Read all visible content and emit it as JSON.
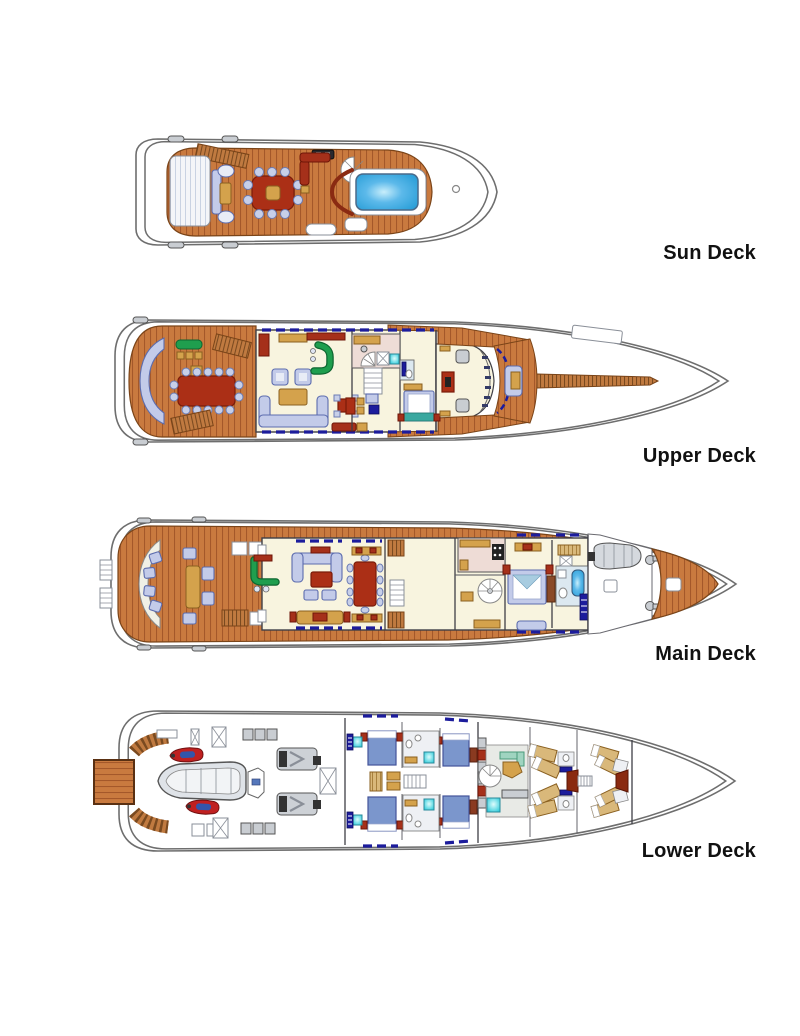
{
  "page": {
    "background": "#ffffff"
  },
  "decks": [
    {
      "id": "sun-deck",
      "label": "Sun Deck"
    },
    {
      "id": "upper-deck",
      "label": "Upper Deck"
    },
    {
      "id": "main-deck",
      "label": "Main Deck"
    },
    {
      "id": "lower-deck",
      "label": "Lower Deck"
    }
  ],
  "colors": {
    "wood": "#c97a3f",
    "woodLine": "#a4582a",
    "woodDark": "#7a4418",
    "cream": "#f8f4df",
    "lavender": "#c3cbe9",
    "lavenderStroke": "#5c6cae",
    "red": "#ab2f16",
    "gold": "#d4a24c",
    "green": "#1f9e4e",
    "navy": "#1c1c9c",
    "pool": "#2b9fd8",
    "cyan": "#27ccdc",
    "pink": "#eedcd6",
    "hull": "#6e6e6e",
    "bedBlue": "#7b96cc",
    "crewTan": "#d9b87a",
    "label": "#111111"
  }
}
